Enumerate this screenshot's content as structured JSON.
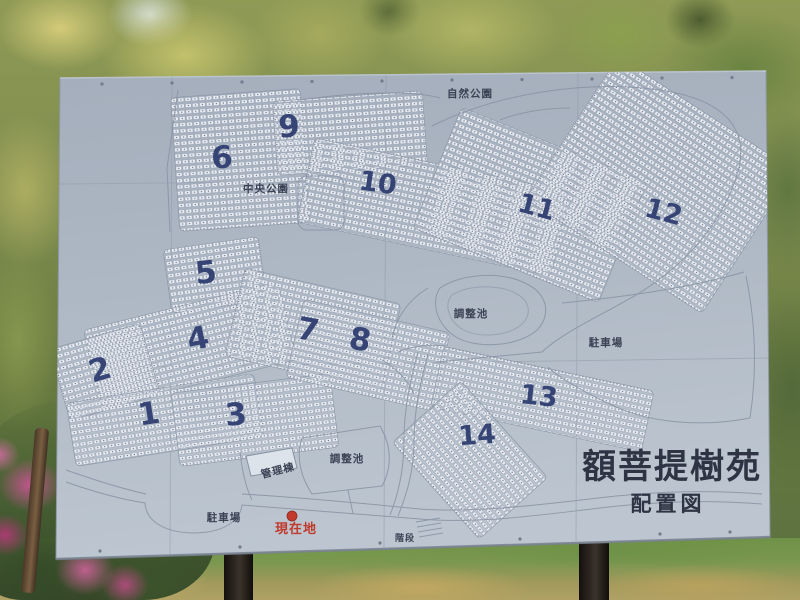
{
  "map_board": {
    "title": "額菩提樹苑",
    "subtitle": "配置図",
    "sections": [
      {
        "label": "1"
      },
      {
        "label": "2"
      },
      {
        "label": "3"
      },
      {
        "label": "4"
      },
      {
        "label": "5"
      },
      {
        "label": "6"
      },
      {
        "label": "7"
      },
      {
        "label": "8"
      },
      {
        "label": "9"
      },
      {
        "label": "10"
      },
      {
        "label": "11"
      },
      {
        "label": "12"
      },
      {
        "label": "13"
      },
      {
        "label": "14"
      }
    ],
    "labels": {
      "nature_park": "自然公園",
      "central_park": "中央公園",
      "regulating_pond_upper": "調整池",
      "regulating_pond_lower": "調整池",
      "parking_east": "駐車場",
      "parking_west": "駐車場",
      "admin_building": "管理棟",
      "stairs": "階段",
      "current_location": "現在地"
    },
    "colors": {
      "board_surface": "#aeb8c4",
      "section_number_blue": "#2b3a6e",
      "map_line_gray": "#8792a3",
      "label_text": "#3a4254",
      "current_location_red": "#c0392b",
      "plot_cell_white": "#e9edf3"
    }
  }
}
